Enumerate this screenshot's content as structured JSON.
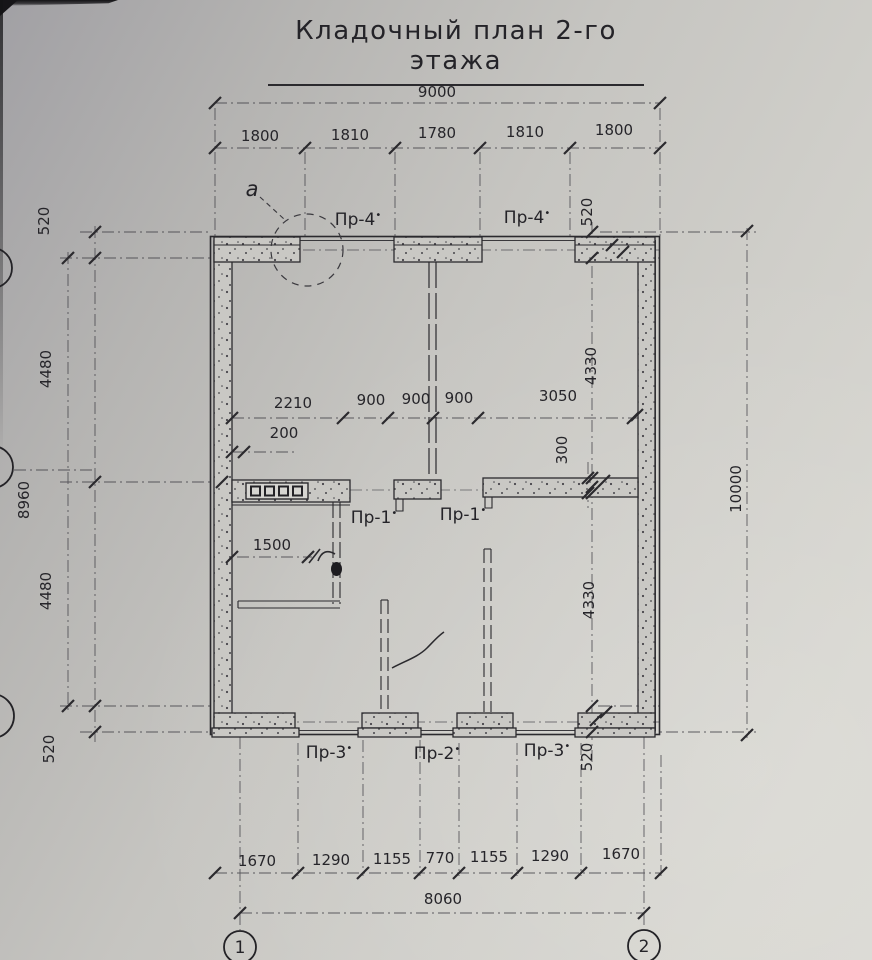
{
  "title": "Кладочный план 2-го этажа",
  "callout_label": "а",
  "axis_bubbles": {
    "bottom": [
      "1",
      "2"
    ]
  },
  "opening_labels": {
    "mark": "•",
    "top": [
      "Пр-4",
      "Пр-4"
    ],
    "middle": [
      "Пр-1",
      "Пр-1"
    ],
    "bottom": [
      "Пр-3",
      "Пр-2",
      "Пр-3"
    ]
  },
  "dimensions": {
    "top": {
      "overall": "9000",
      "segments": [
        "1800",
        "1810",
        "1780",
        "1810",
        "1800"
      ]
    },
    "left": {
      "overall": "8960",
      "segments": [
        "520",
        "4480",
        "4480",
        "520"
      ]
    },
    "right": {
      "overall": "10000",
      "segments": [
        "520",
        "4330",
        "300",
        "4330",
        "520"
      ]
    },
    "interior": {
      "horizontal": [
        "2210",
        "900",
        "900",
        "900",
        "3050"
      ],
      "offset": "200",
      "door": "1500"
    },
    "bottom": {
      "overall": "8060",
      "segments": [
        "1670",
        "1290",
        "1155",
        "770",
        "1155",
        "1290",
        "1670"
      ]
    }
  }
}
